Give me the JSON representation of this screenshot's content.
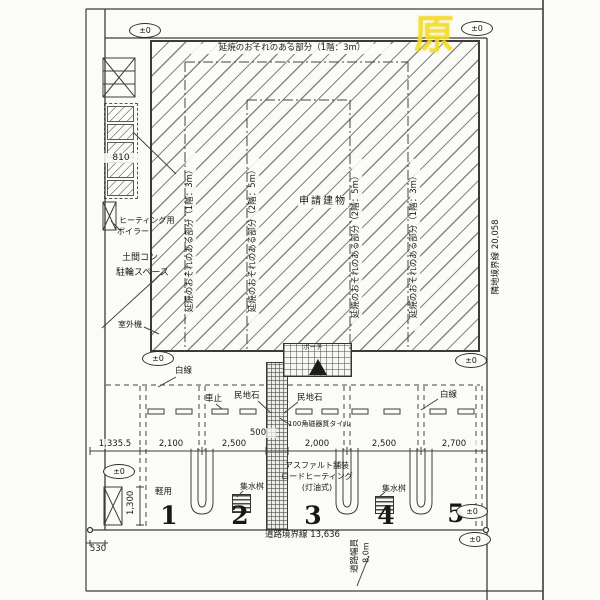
{
  "drawing": {
    "stamp": "原",
    "level_marker": "±0",
    "building_label": "申請建物",
    "fire_zone_top": "延焼のおそれのある部分（1階：3m）",
    "fire_zone_lines": [
      "延焼のおそれのある部分（1階：3m）",
      "延焼のおそれのある部分（2階：5m）",
      "延焼のおそれのある部分（2階：5m）",
      "延焼のおそれのある部分（1階：3m）"
    ]
  },
  "left_side": {
    "rack_width": "810",
    "boiler_line1": "ヒーティング用",
    "boiler_line2": "ボイラー",
    "bike_line1": "土間コン",
    "bike_line2": "駐輪スペース",
    "outdoor_unit": "室外機"
  },
  "parking": {
    "white_line": "白線",
    "wheel_stop": "車止",
    "curb_stone": "民地石",
    "tile": "100角磁器質タイル",
    "porch": "ポーチ",
    "asphalt1": "アスファルト舗装",
    "asphalt2": "ロードヒーティング",
    "asphalt3": "(灯油式)",
    "drain": "集水桝",
    "kei_car": "軽用",
    "space_numbers": [
      "1",
      "2",
      "3",
      "4",
      "5"
    ]
  },
  "dims": {
    "row": [
      "1,335.5",
      "2,100",
      "2,500",
      "500",
      "2,000",
      "2,500",
      "2,700"
    ],
    "offset_530": "530",
    "depth_1300": "1,300",
    "road_line": "道路境界線 13,636",
    "road_width_label": "道路幅員",
    "road_width_value": "8.0m",
    "neighbor_line": "隣地境界線 20,058"
  }
}
